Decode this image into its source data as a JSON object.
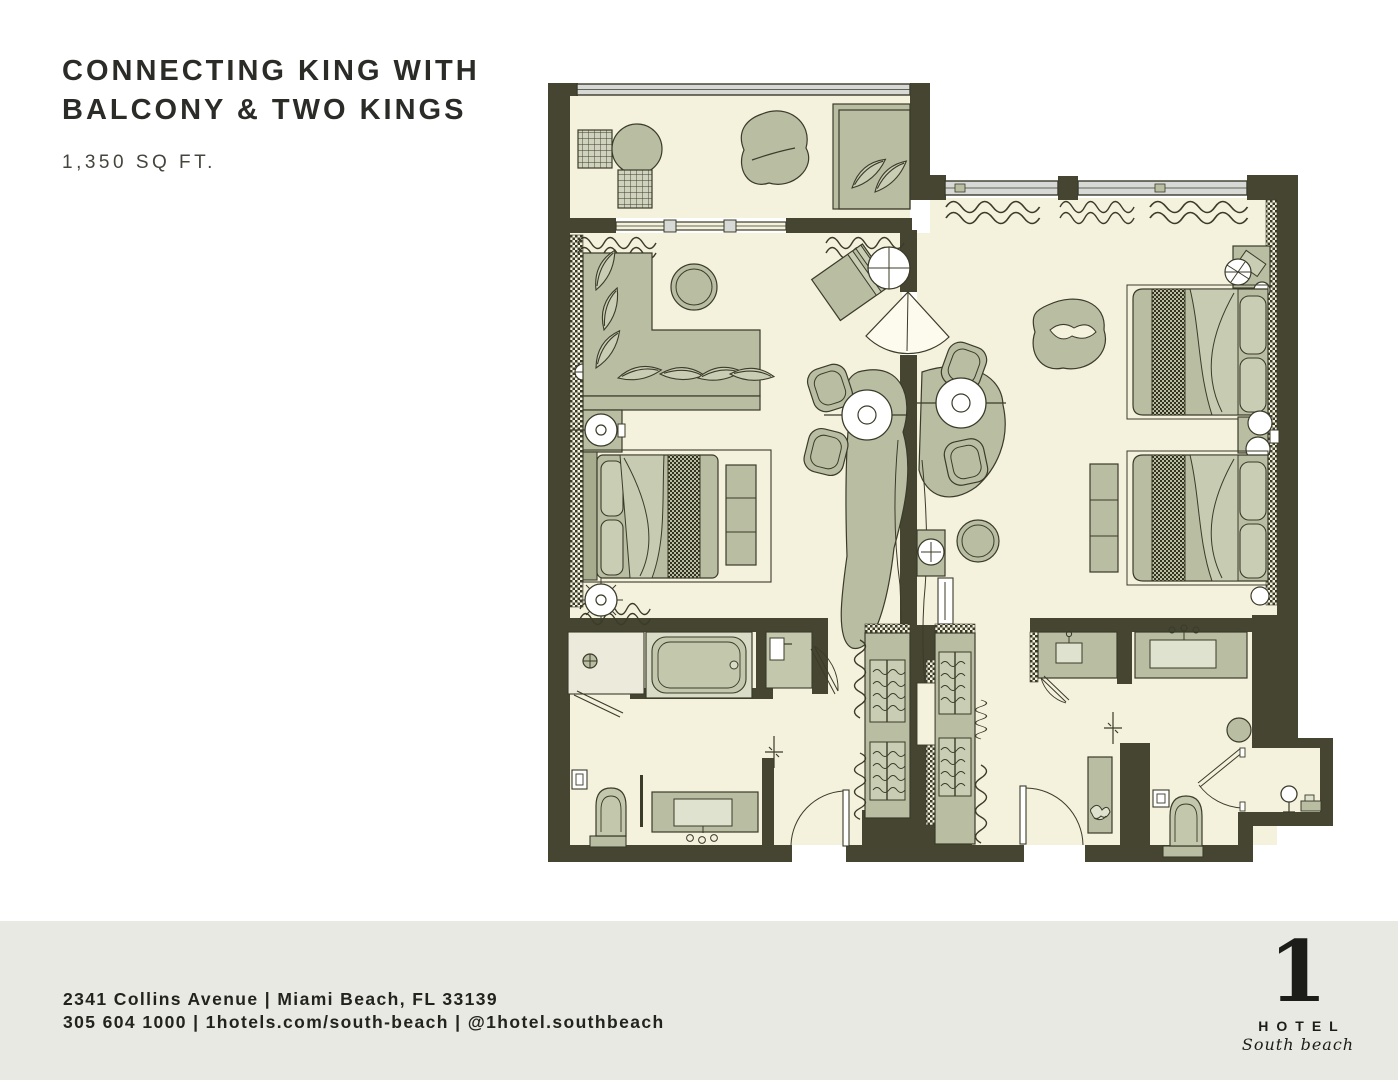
{
  "header": {
    "title_line1": "CONNECTING KING WITH",
    "title_line2": "BALCONY & TWO KINGS",
    "area": "1,350 SQ FT."
  },
  "floorplan": {
    "colors": {
      "wall": "#454531",
      "outline": "#3b3b2a",
      "floor": "#f4f1dd",
      "furniture": "#b9bea2",
      "furniture_light": "#c9cdb3",
      "window_glass": "#d6d9d6",
      "white": "#ffffff",
      "footer_band": "#e9e9e3"
    }
  },
  "footer": {
    "address": "2341 Collins Avenue | Miami Beach, FL 33139",
    "contact": "305 604 1000 | 1hotels.com/south-beach | @1hotel.southbeach"
  },
  "logo": {
    "numeral": "1",
    "name": "HOTEL",
    "sub": "South beach"
  }
}
